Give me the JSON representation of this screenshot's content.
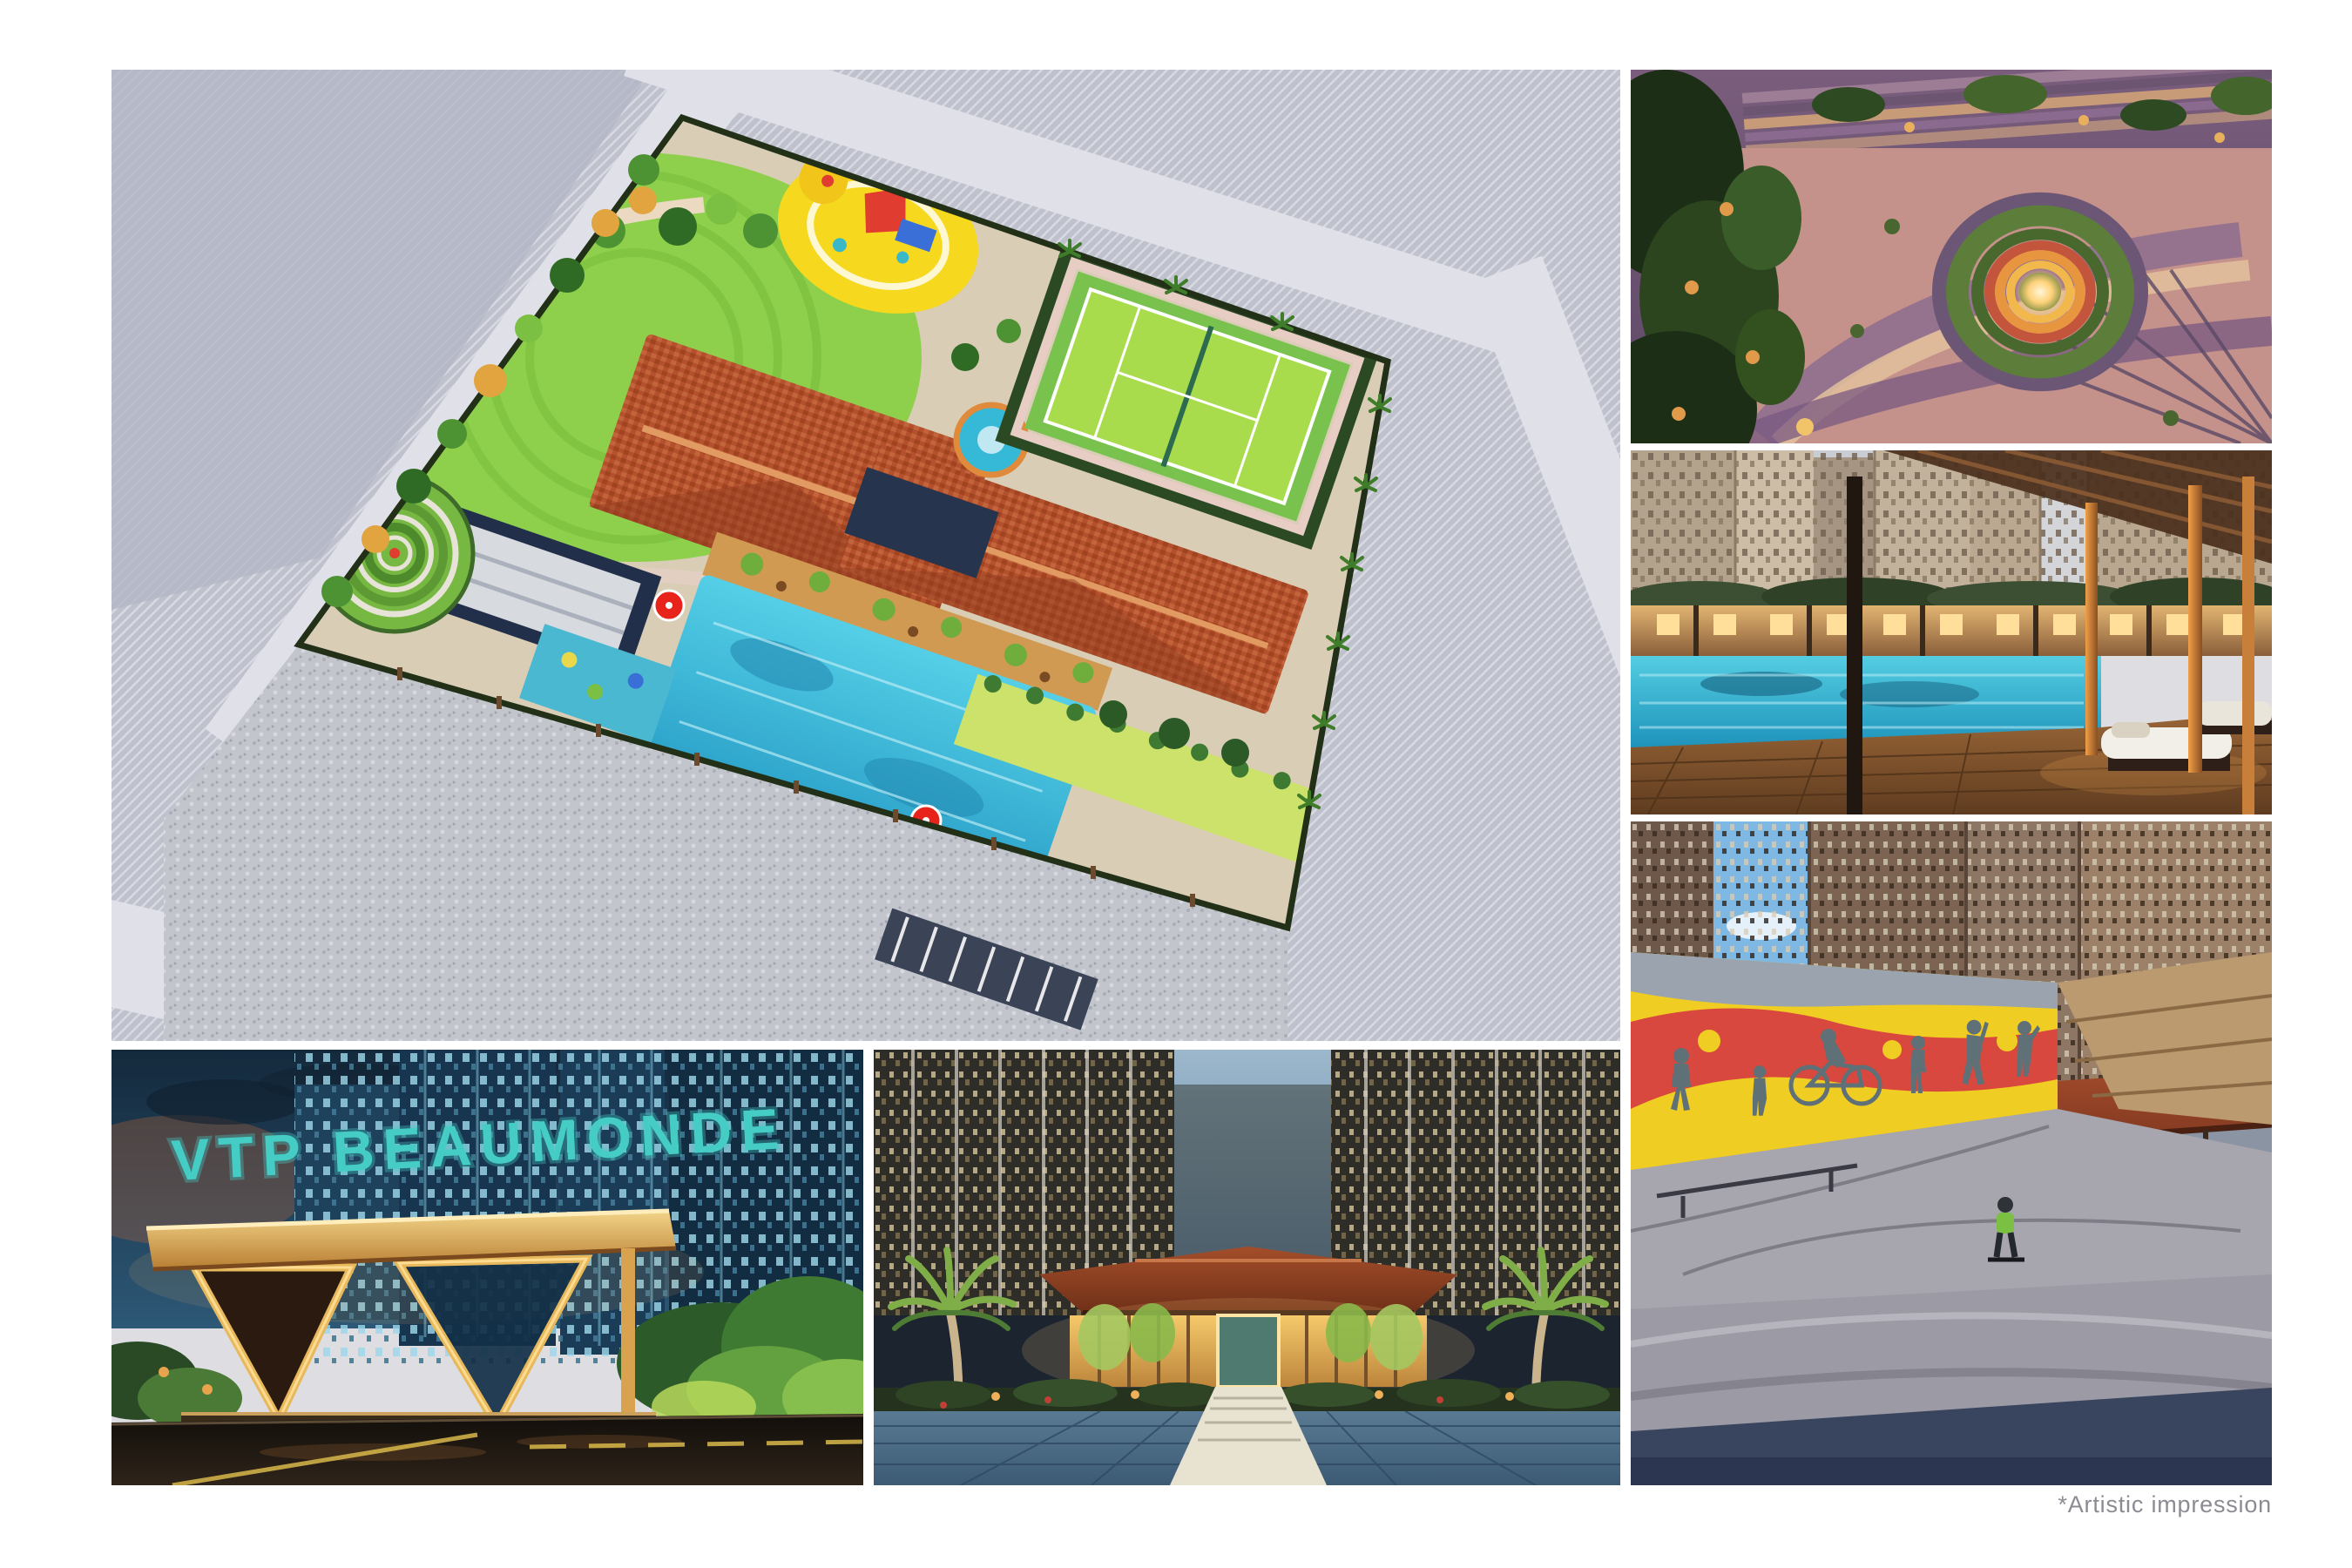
{
  "page": {
    "background": "#ffffff",
    "caption": "*Artistic impression"
  },
  "images": {
    "masterplan": {
      "label": "Aerial master plan of the amenity area with clubhouse, swimming pool, tennis court, lawns and kids play area"
    },
    "fountain": {
      "label": "Illuminated circular fountain court at night"
    },
    "poolside": {
      "label": "Swimming pool, timber deck and cabana lounge at dusk"
    },
    "skatepark": {
      "label": "Skate park with painted mural wall below residential towers"
    },
    "gateway": {
      "label": "Entrance gateway structure at night",
      "sign_text": "VTP BEAUMONDE"
    },
    "entrance": {
      "label": "Grand clubhouse entrance plaza at night"
    }
  },
  "palette": {
    "roof_terracotta": "#b5502e",
    "pool_turquoise": "#3cc0de",
    "lawn_green": "#8cc63f",
    "court_lime": "#a9dc4d",
    "playground_yellow": "#f6d81f",
    "mural_yellow": "#f0cd22",
    "mural_red": "#d8483e",
    "sign_teal": "#45cdc5",
    "gate_gold": "#e8b85c",
    "night_blue": "#17354e",
    "caption_gray": "#8b8b93"
  }
}
